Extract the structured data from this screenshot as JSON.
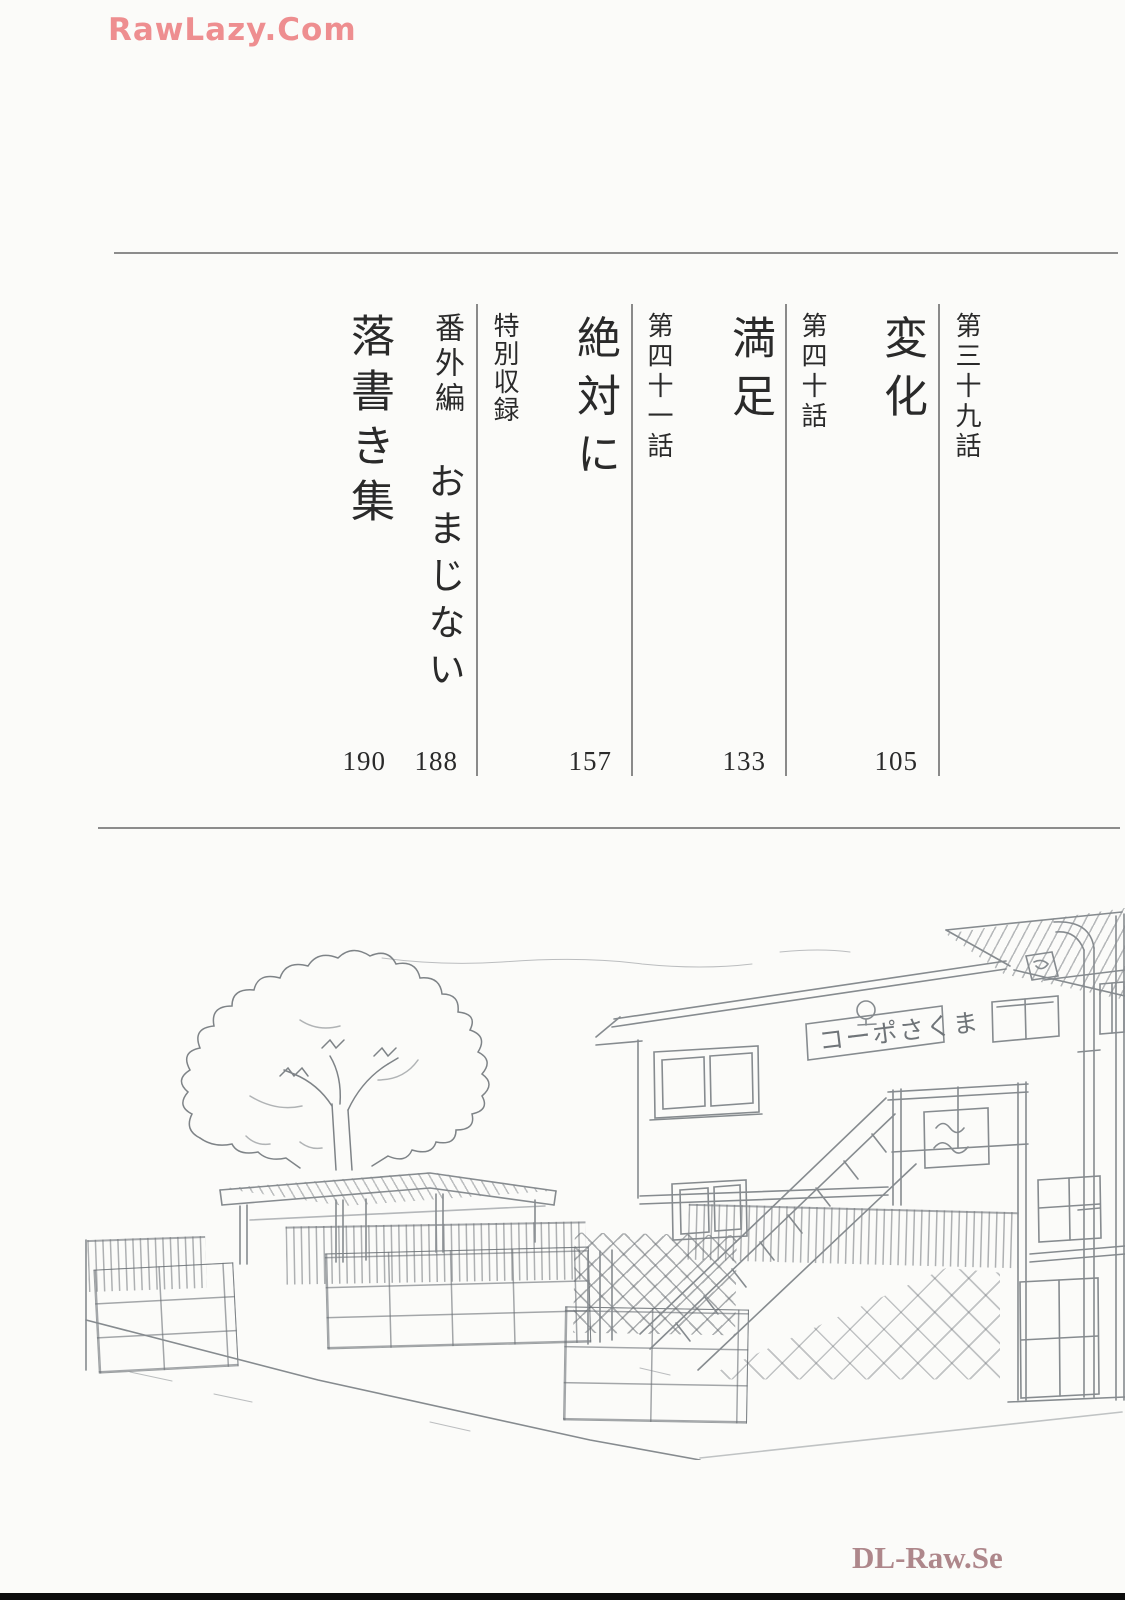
{
  "watermarks": {
    "top": "RawLazy.Com",
    "bottom": "DL-Raw.Se"
  },
  "toc": {
    "entries": [
      {
        "chapter": "第三十九話",
        "title": "変化",
        "page": "105"
      },
      {
        "chapter": "第四十話",
        "title": "満足",
        "page": "133"
      },
      {
        "chapter": "第四十一話",
        "title": "絶対に",
        "page": "157"
      },
      {
        "chapter": "特別収録",
        "title": "",
        "page": ""
      },
      {
        "chapter": "番外編",
        "title": "おまじない",
        "page": "188"
      },
      {
        "chapter": "",
        "title": "落書き集",
        "page": "190"
      }
    ]
  },
  "illustration": {
    "building_sign": "コーポさくま",
    "description": "pencil sketch of an apartment building with exterior staircase, big tree, flat-roof shelter, slat fence and block walls"
  },
  "colors": {
    "watermark_top": "#ee8e90",
    "watermark_bottom": "#ae878b",
    "rule": "#8c8c8c",
    "ink": "#2a2a2a",
    "sketch": "#868b8f",
    "page_background": "#fbfbf9",
    "bottom_bar": "#0c0c0c"
  }
}
